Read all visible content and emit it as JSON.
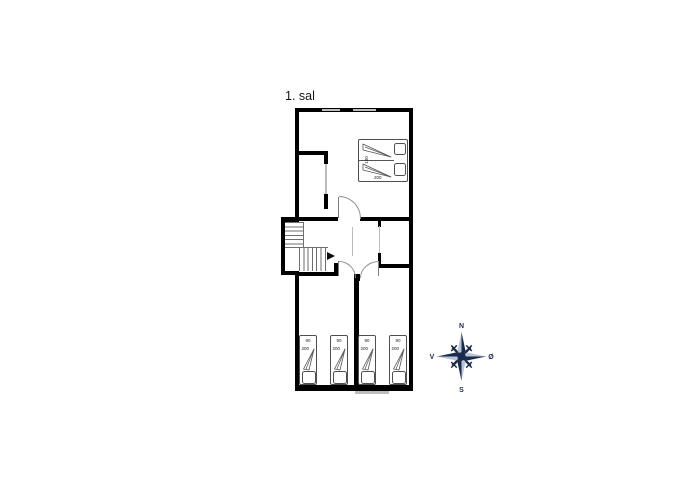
{
  "title": "1. sal",
  "colors": {
    "wall": "#000000",
    "window": "#bdbdbd",
    "thin": "#bcbcbc",
    "compassDark": "#1b2b4d",
    "compassLight": "#b9c6d8"
  },
  "plan": {
    "double_bed": {
      "width_label": "180",
      "length_label": "200"
    },
    "single_beds": [
      {
        "width_label": "90",
        "length_label": "200"
      },
      {
        "width_label": "90",
        "length_label": "200"
      },
      {
        "width_label": "90",
        "length_label": "200"
      },
      {
        "width_label": "90",
        "length_label": "200"
      }
    ]
  },
  "compass": {
    "north": "N",
    "east": "Ø",
    "south": "S",
    "west": "V"
  }
}
